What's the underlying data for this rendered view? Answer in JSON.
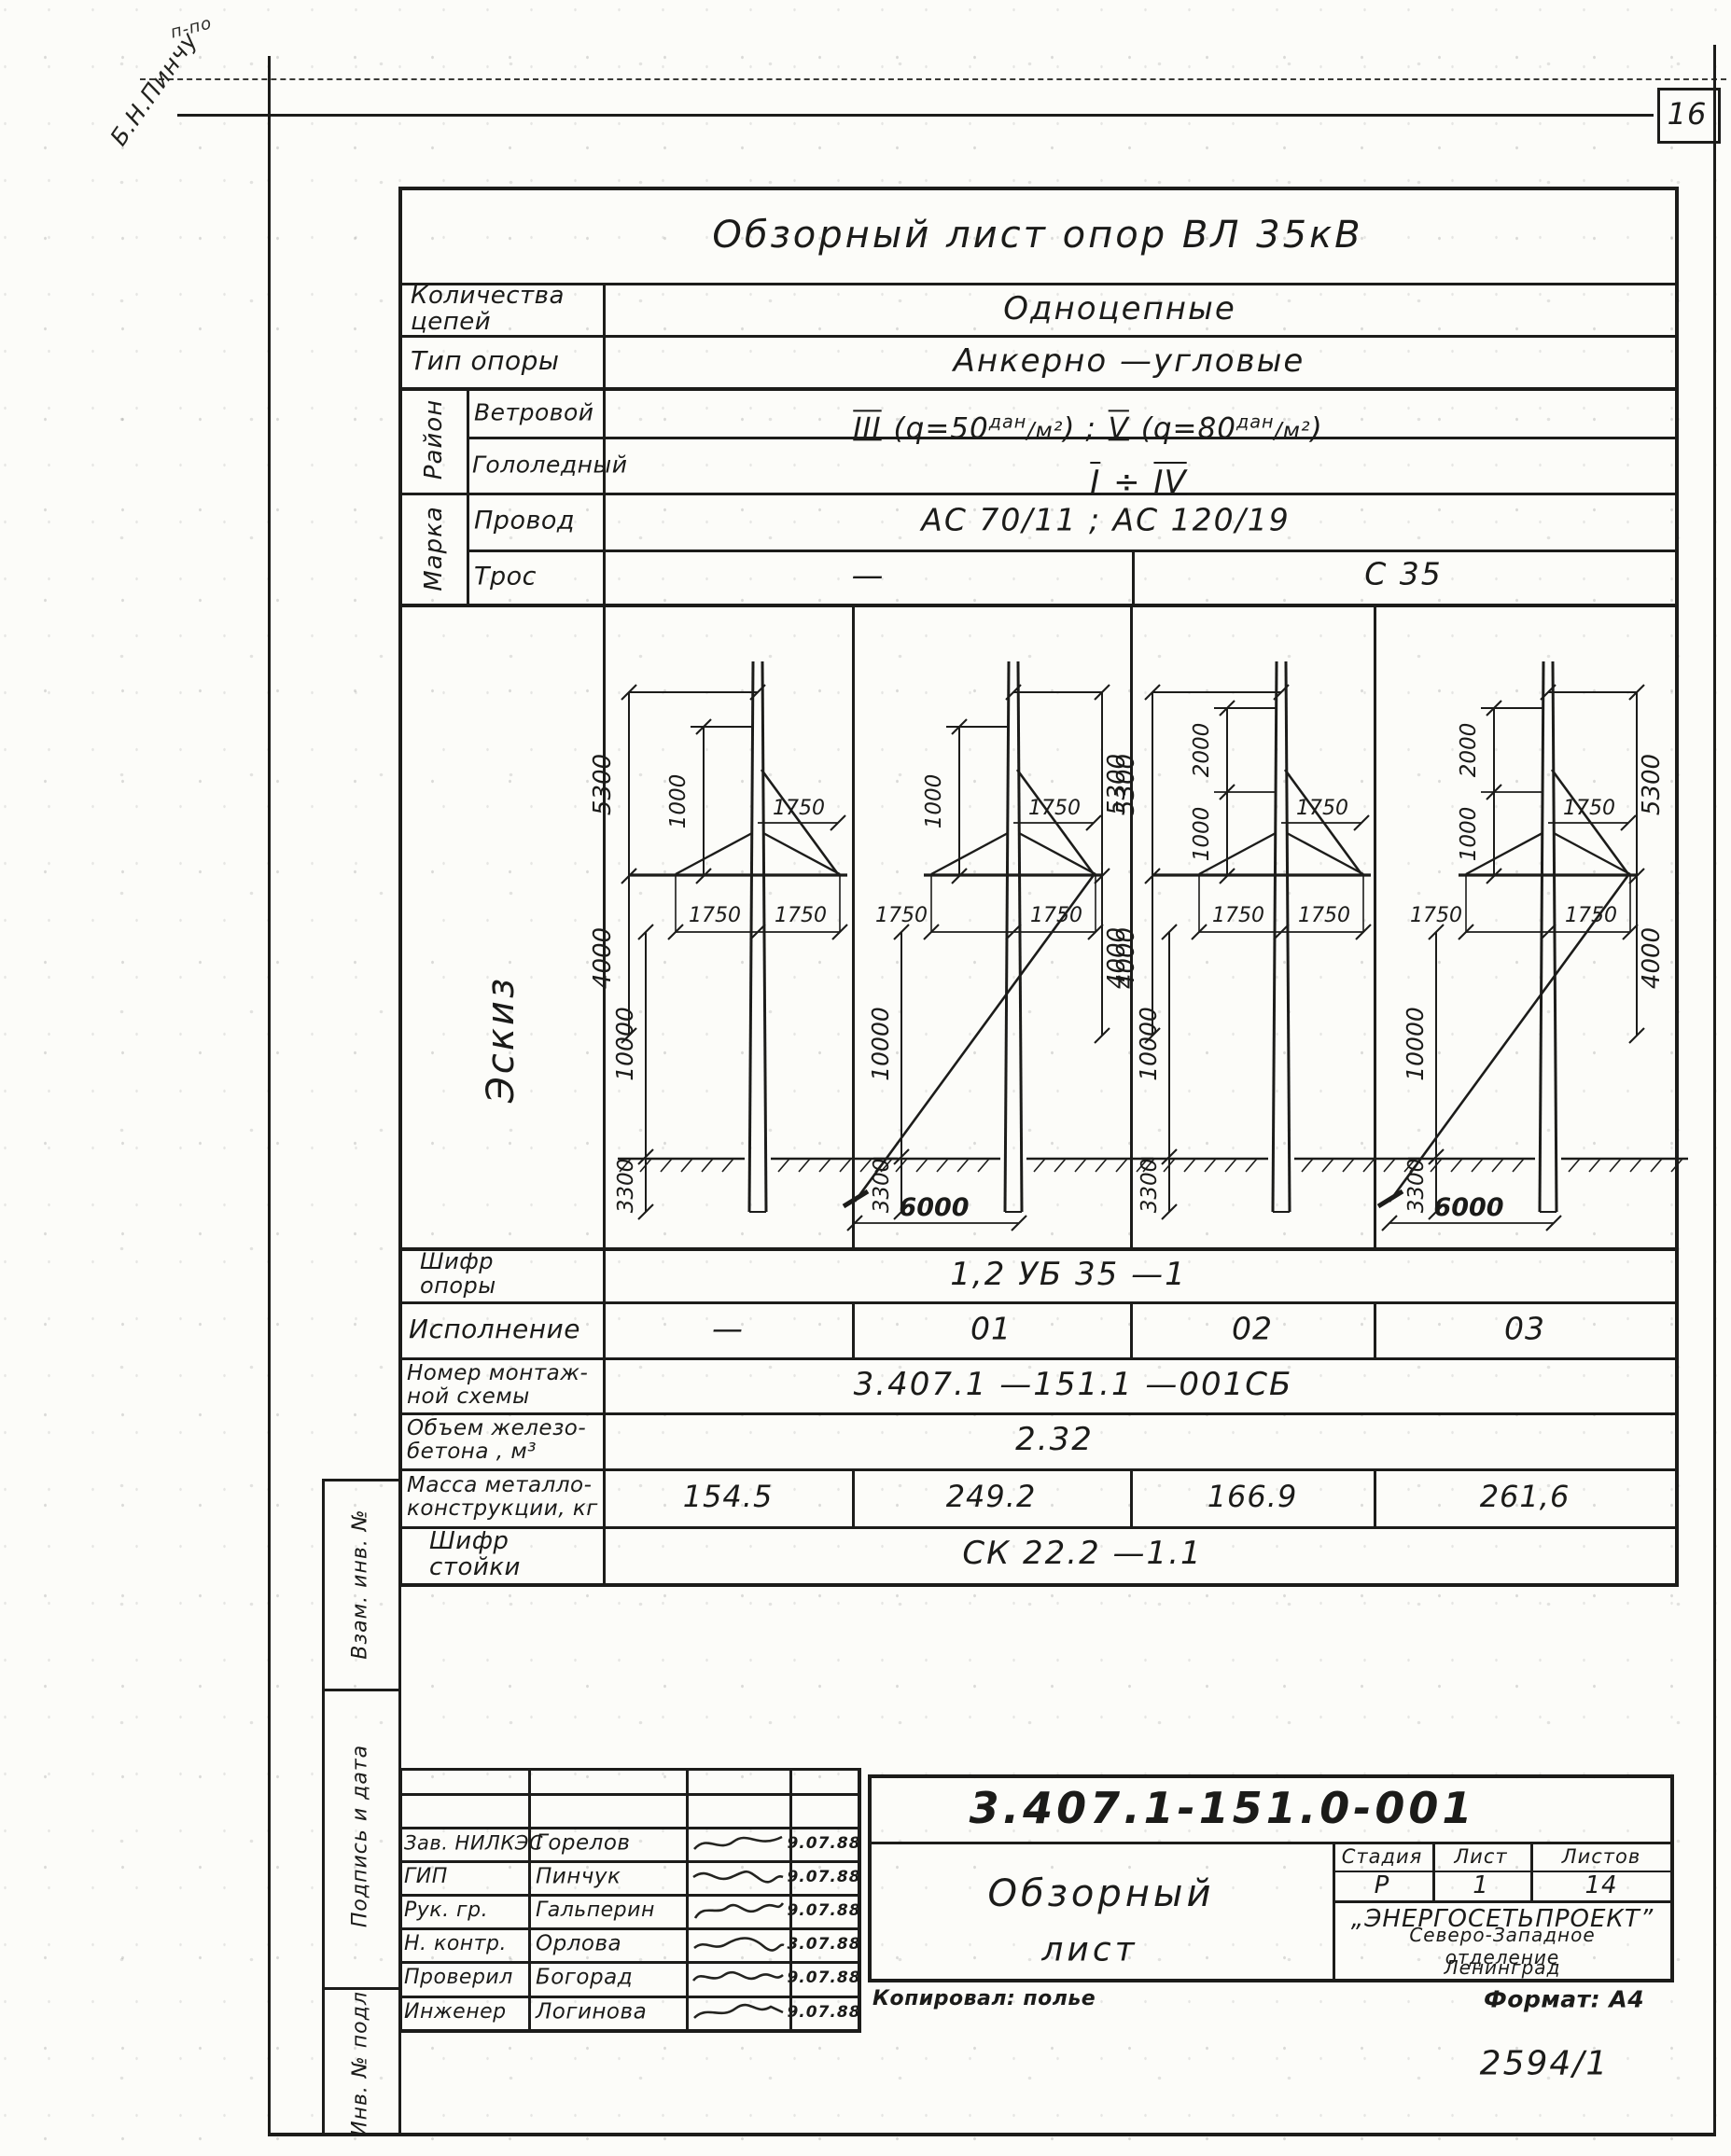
{
  "page": {
    "number": "16",
    "archive_number": "2594/1",
    "format": "Формат: А4",
    "copied": "Копировал: полье",
    "handwriting_small": "п-по",
    "handwriting_main": "Б.Н.Пинчу"
  },
  "title": "Обзорный лист опор ВЛ 35кВ",
  "spec": {
    "circuits_label": "Количества\nцепей",
    "circuits_value": "Одноцепные",
    "type_label": "Тип опоры",
    "type_value": "Анкерно  —угловые",
    "raion": "Район",
    "marka": "Марка",
    "wind": {
      "label": "Ветровой",
      "roman1": "III",
      "t1": " (q=50",
      "sup1": "дан",
      "d1": "/м²",
      "t2": ") ;  ",
      "roman2": "V",
      "t3": " (q=80",
      "sup2": "дан",
      "d2": "/м²",
      "t4": ")"
    },
    "ice": {
      "label": "Гололедный",
      "r1": "I",
      "sep": " ÷ ",
      "r2": "IV"
    },
    "wire": {
      "label": "Провод",
      "value": "АС 70/11 ;    АС 120/19"
    },
    "cable": {
      "label": "Трос",
      "left": "—",
      "right": "С 35"
    }
  },
  "eskiz_label": "Эскиз",
  "sketches": [
    {
      "execution": "—",
      "top": "5300",
      "mid": "4000",
      "inner": [
        "1000"
      ],
      "bracket": "1750",
      "arm_left": "1750",
      "arm_right": "1750",
      "height": "10000",
      "depth": "3300",
      "guy": null,
      "mirrored": false
    },
    {
      "execution": "01",
      "top": "5300",
      "mid": "4000",
      "inner": [
        "1000"
      ],
      "bracket": "1750",
      "arm_left": "1750",
      "arm_right": "1750",
      "height": "10000",
      "depth": "3300",
      "guy": "6000",
      "mirrored": true
    },
    {
      "execution": "02",
      "top": "5300",
      "mid": "4000",
      "inner": [
        "2000",
        "1000"
      ],
      "bracket": "1750",
      "arm_left": "1750",
      "arm_right": "1750",
      "height": "10000",
      "depth": "3300",
      "guy": null,
      "mirrored": false
    },
    {
      "execution": "03",
      "top": "5300",
      "mid": "4000",
      "inner": [
        "2000",
        "1000"
      ],
      "bracket": "1750",
      "arm_left": "1750",
      "arm_right": "1750",
      "height": "10000",
      "depth": "3300",
      "guy": "6000",
      "mirrored": true
    }
  ],
  "results": {
    "shifr_opory": {
      "label": "Шифр\nопоры",
      "value": "1,2 УБ 35 —1"
    },
    "ispolnenie": {
      "label": "Исполнение",
      "values": [
        "—",
        "01",
        "02",
        "03"
      ]
    },
    "montazh": {
      "label": "Номер монтаж-\nной схемы",
      "value": "3.407.1  —151.1 —001СБ"
    },
    "beton": {
      "label": "Объем железо-\nбетона , м³",
      "value": "2.32"
    },
    "massa": {
      "label": "Масса металло-\nконструкции, кг",
      "values": [
        "154.5",
        "249.2",
        "166.9",
        "261,6"
      ]
    },
    "shifr_stoyki": {
      "label": "Шифр\nстойки",
      "value": "СК 22.2 —1.1"
    }
  },
  "margin": {
    "box1": "Взам. инв. №",
    "box2": "Подпись и дата",
    "box3": "Инв. № подл."
  },
  "signatures": {
    "rows": [
      {
        "role": "Зав. НИЛКЭС",
        "name": "Горелов",
        "date": "9.07.88"
      },
      {
        "role": "ГИП",
        "name": "Пинчук",
        "date": "9.07.88"
      },
      {
        "role": "Рук. гр.",
        "name": "Гальперин",
        "date": "9.07.88"
      },
      {
        "role": "Н. контр.",
        "name": "Орлова",
        "date": "3.07.88"
      },
      {
        "role": "Проверил",
        "name": "Богорад",
        "date": "9.07.88"
      },
      {
        "role": "Инженер",
        "name": "Логинова",
        "date": "9.07.88"
      }
    ]
  },
  "stamp": {
    "doc_number": "3.407.1-151.0-001",
    "title_line1": "Обзорный",
    "title_line2": "лист",
    "stage_label": "Стадия",
    "sheet_label": "Лист",
    "sheets_label": "Листов",
    "stage": "Р",
    "sheet": "1",
    "sheets": "14",
    "org1": "„ЭНЕРГОСЕТЬПРОЕКТ”",
    "org2": "Северо-Западное отделение",
    "org3": "Ленинград"
  }
}
